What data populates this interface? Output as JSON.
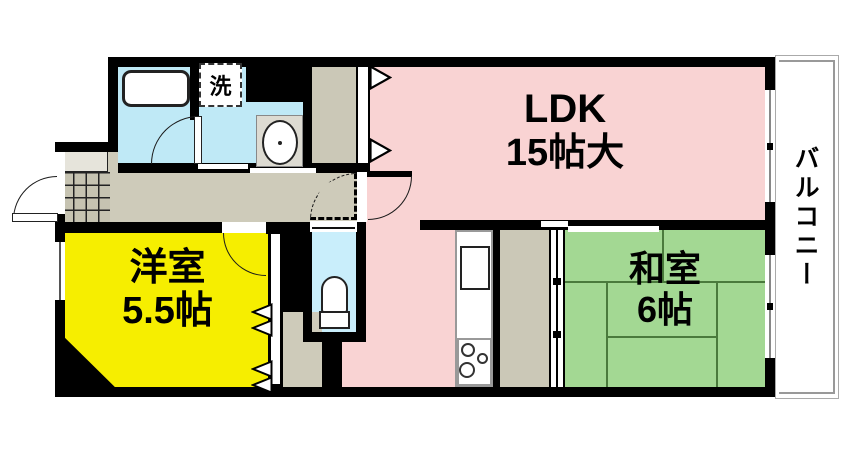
{
  "title": "apartment-floor-plan",
  "rooms": {
    "ldk": {
      "label": "LDK",
      "size": "15帖大"
    },
    "western": {
      "label": "洋室",
      "size": "5.5帖"
    },
    "japanese": {
      "label": "和室",
      "size": "6帖"
    },
    "balcony": {
      "label": "バルコニー"
    },
    "laundry": {
      "label": "洗"
    }
  },
  "colors": {
    "ldk": "#f9d3d3",
    "western": "#f6ee00",
    "japanese": "#a3d893",
    "wet": "#bfe9f6",
    "toilet": "#c9eefb",
    "hall": "#cecbba",
    "closet": "#cbc8b7",
    "tile": "#c6c3b1",
    "wall": "#000000",
    "tatami-line": "#4a7a3c",
    "balcony-line": "#999999",
    "shoe": "#e6e4db"
  }
}
